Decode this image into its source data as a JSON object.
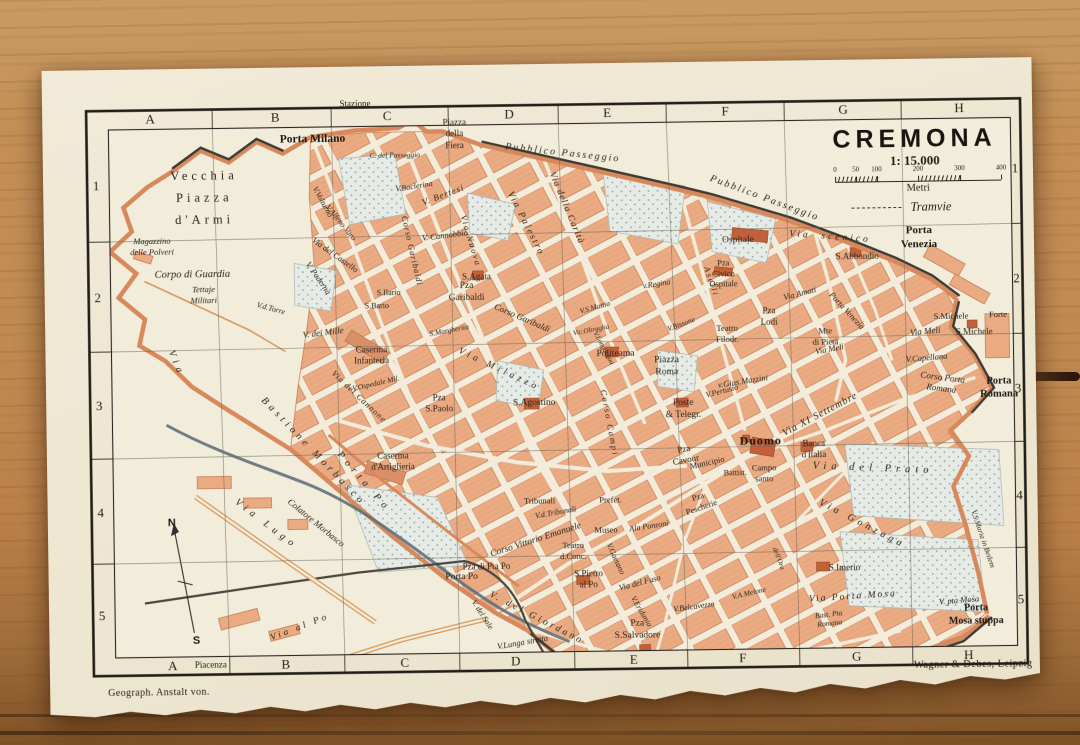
{
  "colors": {
    "paper": "#EFE8D4",
    "ink": "#2b251b",
    "city_block": "#EAAB82",
    "block_edge": "#C87D54",
    "park": "#E7EBE6",
    "wall": "#D8895C",
    "water": "#60707A",
    "wood": "#C08A52"
  },
  "map": {
    "title": "CREMONA",
    "scale": "1: 15.000",
    "scale_unit": "Metri",
    "scale_ticks": [
      {
        "label": "0",
        "pos": 0
      },
      {
        "label": "50",
        "pos": 12.5
      },
      {
        "label": "100",
        "pos": 25
      },
      {
        "label": "200",
        "pos": 50
      },
      {
        "label": "300",
        "pos": 75
      },
      {
        "label": "400",
        "pos": 100
      }
    ],
    "legend_tramvie": "Tramvie",
    "grid": {
      "cols": [
        "A",
        "B",
        "C",
        "D",
        "E",
        "F",
        "G",
        "H"
      ],
      "rows": [
        "1",
        "2",
        "3",
        "4",
        "5"
      ]
    },
    "outside": {
      "top": "Stazione",
      "bottom": "Piacenza"
    },
    "imprint_left": "Geograph. Anstalt von.",
    "imprint_right": "Wagner & Debes, Leipzig",
    "labels": [
      {
        "t": "Porta Milano",
        "x": 270,
        "y": 72,
        "s": 11.5,
        "b": 1
      },
      {
        "t": "Vecchia\nPiazza\nd'Armi",
        "x": 161,
        "y": 130,
        "s": 12.5,
        "ls": 4,
        "lh": 1.75
      },
      {
        "t": "Magazzino\ndelle Polveri",
        "x": 108,
        "y": 177,
        "s": 8.5,
        "i": 1
      },
      {
        "t": "Corpo di Guardia",
        "x": 148,
        "y": 206,
        "s": 10.5,
        "i": 1
      },
      {
        "t": "Tettaje\nMilitari",
        "x": 159,
        "y": 226,
        "s": 8.5,
        "i": 1
      },
      {
        "t": "Piazza\ndella\nFiera",
        "x": 412,
        "y": 69,
        "s": 9
      },
      {
        "t": "C. del Passeggio",
        "x": 352,
        "y": 89,
        "s": 7.5,
        "i": 1
      },
      {
        "t": "Pubblico Passeggio",
        "x": 520,
        "y": 90,
        "s": 10,
        "i": 1,
        "ls": 2,
        "r": 7
      },
      {
        "t": "Pubblico Passeggio",
        "x": 721,
        "y": 138,
        "s": 10,
        "i": 1,
        "ls": 2,
        "r": 21
      },
      {
        "t": "Porta\nVenezia",
        "x": 875,
        "y": 179,
        "s": 11,
        "b": 1
      },
      {
        "t": "V.Volturno",
        "x": 279,
        "y": 135,
        "s": 8,
        "i": 1,
        "r": 62
      },
      {
        "t": "V.Alfeno Varo",
        "x": 297,
        "y": 156,
        "s": 8,
        "i": 1,
        "r": 52
      },
      {
        "t": "Via del Castello",
        "x": 291,
        "y": 188,
        "s": 8.5,
        "i": 1,
        "r": 36
      },
      {
        "t": "V. Paderna",
        "x": 274,
        "y": 211,
        "s": 8.5,
        "i": 1,
        "r": 56
      },
      {
        "t": "V.d.Torre",
        "x": 226,
        "y": 241,
        "s": 8,
        "i": 1,
        "r": 16
      },
      {
        "t": "V. dei Mille",
        "x": 278,
        "y": 266,
        "s": 9,
        "i": 1,
        "r": -6
      },
      {
        "t": "S.Ilario",
        "x": 344,
        "y": 227,
        "s": 8
      },
      {
        "t": "S.Bario",
        "x": 332,
        "y": 240,
        "s": 8
      },
      {
        "t": "Caserma\nInfanteria",
        "x": 326,
        "y": 289,
        "s": 9
      },
      {
        "t": "V.Ospedale Mil.",
        "x": 330,
        "y": 317,
        "s": 7.5,
        "i": 1,
        "r": -12
      },
      {
        "t": "Via del Cannone",
        "x": 313,
        "y": 330,
        "s": 8.5,
        "i": 1,
        "r": 44,
        "ls": 1
      },
      {
        "t": "Caserma\nd'Artiglieria",
        "x": 346,
        "y": 396,
        "s": 9
      },
      {
        "t": "Via",
        "x": 130,
        "y": 295,
        "s": 10,
        "i": 1,
        "ls": 5,
        "r": 68
      },
      {
        "t": "Bastione Morbasco",
        "x": 266,
        "y": 385,
        "s": 10,
        "i": 1,
        "ls": 4,
        "r": 47
      },
      {
        "t": "Porta Po",
        "x": 316,
        "y": 416,
        "s": 10,
        "i": 1,
        "ls": 5,
        "r": 50
      },
      {
        "t": "Colatore Morbasco",
        "x": 268,
        "y": 456,
        "s": 9,
        "i": 1,
        "r": 40
      },
      {
        "t": "Via Lugo",
        "x": 218,
        "y": 457,
        "s": 10,
        "i": 1,
        "ls": 5,
        "r": 38
      },
      {
        "t": "Via al Po",
        "x": 251,
        "y": 561,
        "s": 9.5,
        "i": 1,
        "ls": 3,
        "r": -20
      },
      {
        "t": "N",
        "x": 124,
        "y": 455,
        "s": 11,
        "b": 1,
        "sans": 1
      },
      {
        "t": "S",
        "x": 147,
        "y": 573,
        "s": 11,
        "b": 1,
        "sans": 1
      },
      {
        "t": "Pza\nGaribaldi",
        "x": 422,
        "y": 228,
        "s": 9.5
      },
      {
        "t": "Corso Garibaldi",
        "x": 477,
        "y": 254,
        "s": 9,
        "i": 1,
        "r": 24
      },
      {
        "t": "Corso Garibaldi",
        "x": 368,
        "y": 185,
        "s": 8.5,
        "i": 1,
        "r": 78,
        "ls": 1
      },
      {
        "t": "S.Agata",
        "x": 432,
        "y": 212,
        "s": 9
      },
      {
        "t": "V.Baclerina",
        "x": 371,
        "y": 121,
        "s": 8,
        "i": 1,
        "r": -8
      },
      {
        "t": "V. Bertesi",
        "x": 400,
        "y": 130,
        "s": 9,
        "i": 1,
        "r": -20,
        "ls": 1
      },
      {
        "t": "V. Cannobbio",
        "x": 401,
        "y": 170,
        "s": 8.5,
        "i": 1,
        "r": -6
      },
      {
        "t": "Via Nuova",
        "x": 427,
        "y": 176,
        "s": 8.5,
        "i": 1,
        "r": 74,
        "ls": 2
      },
      {
        "t": "Via Palestro",
        "x": 481,
        "y": 160,
        "s": 9.5,
        "i": 1,
        "r": 64,
        "ls": 2
      },
      {
        "t": "Via della Carità",
        "x": 522,
        "y": 145,
        "s": 9.5,
        "i": 1,
        "r": 68,
        "ls": 1
      },
      {
        "t": "Via Milazzo",
        "x": 453,
        "y": 306,
        "s": 9.5,
        "i": 1,
        "r": 26,
        "ls": 4
      },
      {
        "t": "S.Margherita",
        "x": 404,
        "y": 265,
        "s": 7.5,
        "i": 1,
        "r": -10
      },
      {
        "t": "Pza\nS.Paolo",
        "x": 393,
        "y": 338,
        "s": 9
      },
      {
        "t": "S.Agostino",
        "x": 488,
        "y": 340,
        "s": 9.5
      },
      {
        "t": "Politeama",
        "x": 570,
        "y": 292,
        "s": 9.5
      },
      {
        "t": "Piazza\nRoma",
        "x": 621,
        "y": 305,
        "s": 9.5
      },
      {
        "t": "Corso Campi",
        "x": 563,
        "y": 360,
        "s": 8.5,
        "i": 1,
        "r": 80,
        "ls": 2
      },
      {
        "t": "Aselli",
        "x": 667,
        "y": 220,
        "s": 8.5,
        "i": 1,
        "r": 72,
        "ls": 2
      },
      {
        "t": "v.Regina",
        "x": 612,
        "y": 222,
        "s": 8,
        "i": 1,
        "r": -8
      },
      {
        "t": "V.S.Mattia",
        "x": 550,
        "y": 244,
        "s": 7.5,
        "i": 1,
        "r": -15
      },
      {
        "t": "Vic.Oltraglia",
        "x": 546,
        "y": 267,
        "s": 7,
        "i": 1,
        "r": -10
      },
      {
        "t": "V.Longacqua",
        "x": 558,
        "y": 285,
        "s": 7,
        "i": 1,
        "r": 62
      },
      {
        "t": "V.Bissone",
        "x": 636,
        "y": 262,
        "s": 7.5,
        "i": 1,
        "r": -20
      },
      {
        "t": "Teatro\nFilodr.",
        "x": 682,
        "y": 272,
        "s": 8.5
      },
      {
        "t": "Pza\nLodi",
        "x": 724,
        "y": 256,
        "s": 9
      },
      {
        "t": "Ospitale",
        "x": 694,
        "y": 180,
        "s": 9.5
      },
      {
        "t": "Pza\nCivico\nOspitale",
        "x": 679,
        "y": 212,
        "s": 8.5
      },
      {
        "t": "S.Abbondio",
        "x": 813,
        "y": 197,
        "s": 9
      },
      {
        "t": "Via  scenico",
        "x": 786,
        "y": 178,
        "s": 9.5,
        "i": 1,
        "ls": 3,
        "r": 5
      },
      {
        "t": "Porta Venezia",
        "x": 802,
        "y": 251,
        "s": 8.5,
        "i": 1,
        "r": 48
      },
      {
        "t": "Via Amati",
        "x": 755,
        "y": 233,
        "s": 8.5,
        "i": 1,
        "r": -14
      },
      {
        "t": "Mte\ndi Pietà",
        "x": 780,
        "y": 276,
        "s": 8.5
      },
      {
        "t": "Via Meli",
        "x": 880,
        "y": 273,
        "s": 9,
        "i": 1,
        "r": -5
      },
      {
        "t": "Via Meli",
        "x": 784,
        "y": 289,
        "s": 8.5,
        "i": 1,
        "r": -10
      },
      {
        "t": "S.Michele",
        "x": 906,
        "y": 258,
        "s": 8.5
      },
      {
        "t": "Forte",
        "x": 953,
        "y": 257,
        "s": 8.5
      },
      {
        "t": "S.Michele",
        "x": 929,
        "y": 274,
        "s": 9
      },
      {
        "t": "V.Capellana",
        "x": 881,
        "y": 299,
        "s": 8.5,
        "i": 1,
        "r": -4
      },
      {
        "t": "Corso Porta\nRomana",
        "x": 896,
        "y": 325,
        "s": 9,
        "i": 1,
        "r": 8
      },
      {
        "t": "Porta\nRomana",
        "x": 953,
        "y": 330,
        "s": 10.5,
        "b": 1
      },
      {
        "t": "Via XI Settembre",
        "x": 774,
        "y": 355,
        "s": 10,
        "i": 1,
        "r": -27,
        "ls": 1
      },
      {
        "t": "Banca\nd'Italia",
        "x": 767,
        "y": 389,
        "s": 9
      },
      {
        "t": "Duomo",
        "x": 714,
        "y": 380,
        "s": 12,
        "b": 1,
        "ls": 1
      },
      {
        "t": "Campo\nsanto",
        "x": 717,
        "y": 412,
        "s": 8.5
      },
      {
        "t": "Battist.",
        "x": 688,
        "y": 412,
        "s": 8
      },
      {
        "t": "Pza\nCavour",
        "x": 638,
        "y": 393,
        "s": 9,
        "r": -10
      },
      {
        "t": "Municipio",
        "x": 660,
        "y": 401,
        "s": 8.5,
        "r": -12
      },
      {
        "t": "Pza\nPescherie",
        "x": 652,
        "y": 440,
        "s": 8.5,
        "r": -18
      },
      {
        "t": "Poste\n& Telegr.",
        "x": 637,
        "y": 348,
        "s": 9.5
      },
      {
        "t": "v.Gius.Mazzini",
        "x": 697,
        "y": 320,
        "s": 8.5,
        "i": 1,
        "r": -8
      },
      {
        "t": "V.Pertusio",
        "x": 676,
        "y": 330,
        "s": 8,
        "i": 1,
        "r": -14
      },
      {
        "t": "Via del Prato",
        "x": 826,
        "y": 409,
        "s": 10.5,
        "i": 1,
        "ls": 5,
        "r": 3
      },
      {
        "t": "Via Gonzaga",
        "x": 814,
        "y": 465,
        "s": 10,
        "i": 1,
        "ls": 4,
        "r": 28
      },
      {
        "t": "S.Imerio",
        "x": 796,
        "y": 508,
        "s": 9
      },
      {
        "t": "Via Porta Mosa",
        "x": 804,
        "y": 538,
        "s": 9.5,
        "i": 1,
        "ls": 2,
        "r": -3
      },
      {
        "t": "V. pta Mosa",
        "x": 910,
        "y": 542,
        "s": 8.5,
        "i": 1,
        "r": -4
      },
      {
        "t": "Porta\nMosa stuppa",
        "x": 927,
        "y": 557,
        "s": 10,
        "b": 1
      },
      {
        "t": "Bast. Pta\nRomana",
        "x": 780,
        "y": 559,
        "s": 7.5,
        "i": 1,
        "r": -6
      },
      {
        "t": "V.S.Maria in Betlem",
        "x": 935,
        "y": 481,
        "s": 7.5,
        "i": 1,
        "r": 72
      },
      {
        "t": "V.A.Melone",
        "x": 700,
        "y": 532,
        "s": 7.5,
        "i": 1,
        "r": -12
      },
      {
        "t": "Corso Vittorio Emanuele",
        "x": 488,
        "y": 477,
        "s": 9.5,
        "i": 1,
        "r": -17
      },
      {
        "t": "Tribunali",
        "x": 492,
        "y": 437,
        "s": 8.5
      },
      {
        "t": "V.d.Tribunali",
        "x": 508,
        "y": 449,
        "s": 8,
        "i": 1,
        "r": -9
      },
      {
        "t": "Prefet.",
        "x": 563,
        "y": 437,
        "s": 8.5
      },
      {
        "t": "Museo",
        "x": 558,
        "y": 467,
        "s": 8.5
      },
      {
        "t": "Ala Ponzoni",
        "x": 601,
        "y": 464,
        "s": 8,
        "i": 1,
        "r": -8
      },
      {
        "t": "Teatro\nd.Conc.",
        "x": 525,
        "y": 487,
        "s": 8.5
      },
      {
        "t": "S.Pietro\nal Po",
        "x": 540,
        "y": 516,
        "s": 9
      },
      {
        "t": "Pza di Pta Po",
        "x": 438,
        "y": 502,
        "s": 9
      },
      {
        "t": "Porta Po",
        "x": 413,
        "y": 513,
        "s": 9.5
      },
      {
        "t": "V. del Giordano",
        "x": 487,
        "y": 555,
        "s": 9.5,
        "i": 1,
        "ls": 3,
        "r": 28
      },
      {
        "t": "V. del Sale",
        "x": 433,
        "y": 550,
        "s": 8,
        "i": 1,
        "r": 58
      },
      {
        "t": "V.Lunga stretta",
        "x": 473,
        "y": 578,
        "s": 8.5,
        "i": 1,
        "r": -9
      },
      {
        "t": "Pza\nS.Salvadore",
        "x": 588,
        "y": 568,
        "s": 9.5
      },
      {
        "t": "V.Eridania",
        "x": 592,
        "y": 549,
        "s": 8,
        "i": 1,
        "r": 60
      },
      {
        "t": "Via del Fuso",
        "x": 591,
        "y": 520,
        "s": 8.5,
        "i": 1,
        "r": -14
      },
      {
        "t": "V.Gaetano",
        "x": 567,
        "y": 496,
        "s": 8,
        "i": 1,
        "r": 66
      },
      {
        "t": "V.Belcavezzo",
        "x": 645,
        "y": 545,
        "s": 8,
        "i": 1,
        "r": -7
      },
      {
        "t": "dell'Ora",
        "x": 730,
        "y": 498,
        "s": 7,
        "i": 1,
        "r": 70
      }
    ]
  }
}
